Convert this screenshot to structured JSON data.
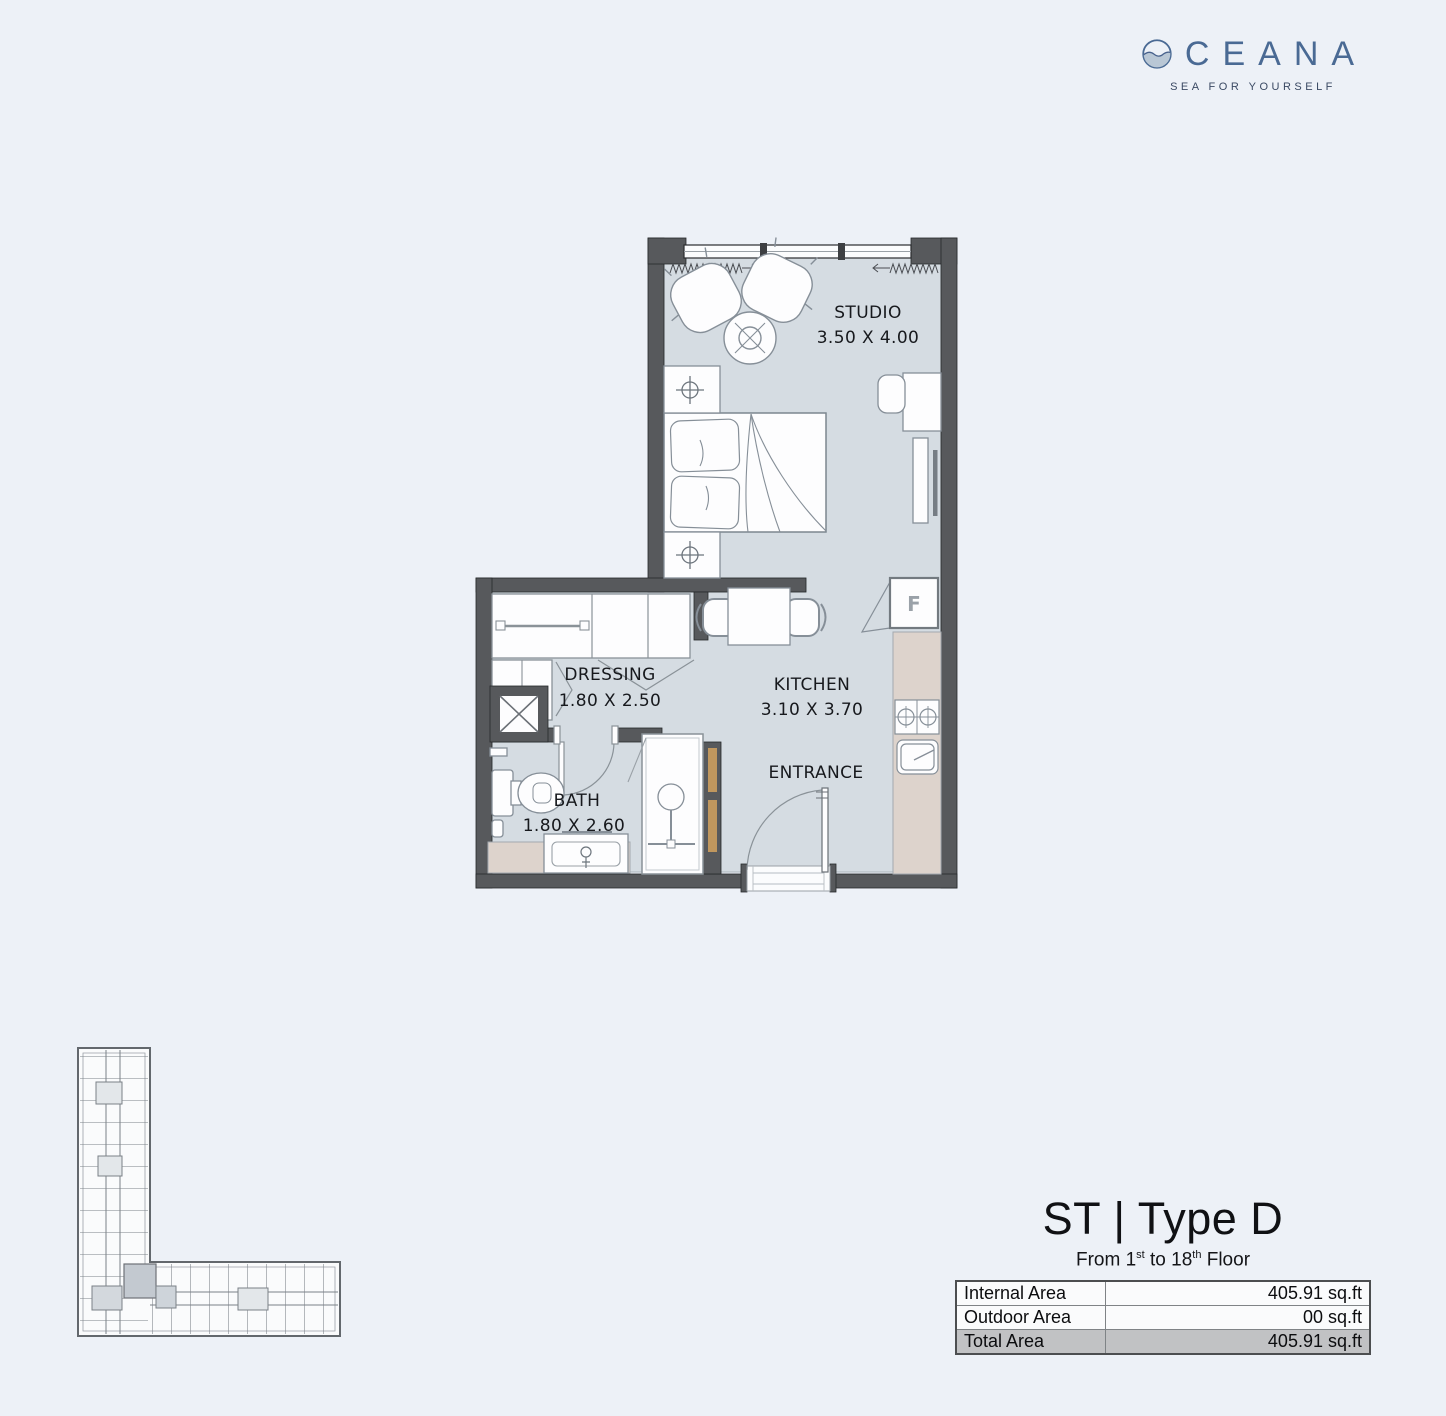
{
  "logo": {
    "name": "OCEANA",
    "wordmark_letters": "CEANA",
    "tagline": "SEA FOR YOURSELF"
  },
  "plan": {
    "rooms": [
      {
        "id": "studio",
        "label": "STUDIO",
        "dimensions": "3.50 X 4.00"
      },
      {
        "id": "dressing",
        "label": "DRESSING",
        "dimensions": "1.80 X 2.50"
      },
      {
        "id": "kitchen",
        "label": "KITCHEN",
        "dimensions": "3.10 X 3.70"
      },
      {
        "id": "bath",
        "label": "BATH",
        "dimensions": "1.80 X 2.60"
      },
      {
        "id": "entrance",
        "label": "ENTRANCE",
        "dimensions": ""
      }
    ],
    "fridge_label": "F"
  },
  "unit_info": {
    "title": "ST | Type D",
    "floor_line": {
      "p1": "From 1",
      "s1": "st",
      "p2": " to 18",
      "s2": "th",
      "p3": " Floor"
    },
    "area_table": {
      "rows": [
        {
          "label": "Internal Area",
          "value": "405.91 sq.ft"
        },
        {
          "label": "Outdoor Area",
          "value": "00 sq.ft"
        },
        {
          "label": "Total Area",
          "value": "405.91 sq.ft"
        }
      ]
    }
  },
  "colors": {
    "brand_blue": "#4a6a94",
    "wall_grey": "#57595c",
    "floor_blue_grey": "#d5dce2",
    "counter_beige": "#ddd3cc",
    "wood_accent": "#c0975e",
    "total_row_grey": "#c1c2c4",
    "background": "#edf1f7"
  }
}
